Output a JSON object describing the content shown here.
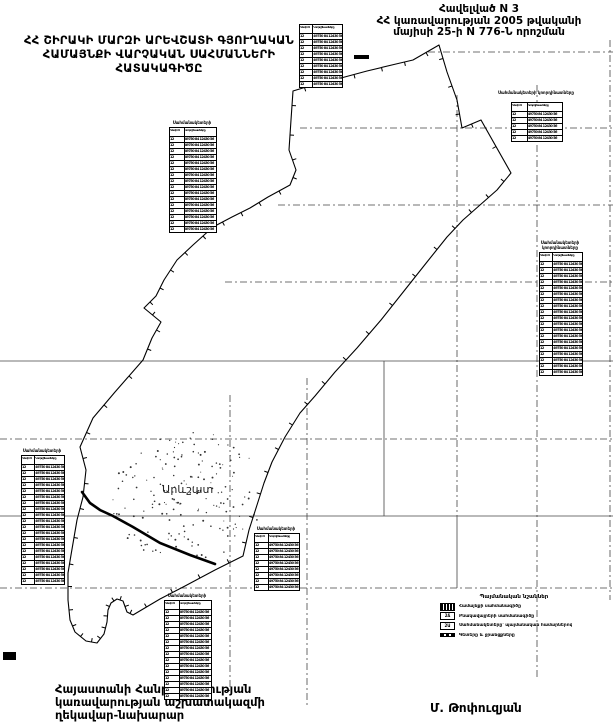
{
  "header_right": {
    "line1": "Հավելված N 3",
    "line2": "ՀՀ կառավարության 2005 թվականի",
    "line3": "մայիսի 25-ի N 776-Ն որոշման"
  },
  "map_title": {
    "line1": "ՀՀ ՇԻՐԱԿԻ ՄԱՐԶԻ ԱՐԵՎՇԱՏԻ ԳՅՈՒՂԱԿԱՆ",
    "line2": "ՀԱՄԱՅՆՔԻ  ՎԱՐՉԱԿԱՆ  ՍԱՀՄԱՆՆԵՐԻ",
    "line3": "ՀԱՏԱԿԱԳԻԾԸ"
  },
  "map": {
    "settlement_label": "Արևշատ"
  },
  "footer": {
    "left_line1": "Հայաստանի Հանրապետության",
    "left_line2": "կառավարության աշխատակազմի",
    "left_line3": "ղեկավար-նախարար",
    "signature": "Մ. Թոփուզյան"
  },
  "tables": {
    "header_col1": "Կետի N",
    "header_col2": "Կոորդինատները",
    "filler_cell1": "12",
    "filler_cell2": "49750 84 12430 56",
    "default_title": "Սահմանակետերի կոորդինատները",
    "items": [
      {
        "id": "coords-top",
        "x": 299,
        "y": 24,
        "w": 42,
        "rows": 9,
        "title_lines": 0
      },
      {
        "id": "coords-upper-left",
        "x": 169,
        "y": 127,
        "w": 46,
        "rows": 16,
        "title_lines": 1
      },
      {
        "id": "coords-right-small",
        "x": 511,
        "y": 102,
        "w": 50,
        "rows": 5,
        "title_lines": 2
      },
      {
        "id": "coords-right-long",
        "x": 539,
        "y": 252,
        "w": 42,
        "rows": 19,
        "title_lines": 2
      },
      {
        "id": "coords-left",
        "x": 21,
        "y": 455,
        "w": 42,
        "rows": 20,
        "title_lines": 1
      },
      {
        "id": "coords-center",
        "x": 254,
        "y": 533,
        "w": 44,
        "rows": 8,
        "title_lines": 1
      },
      {
        "id": "coords-bottom",
        "x": 164,
        "y": 600,
        "w": 46,
        "rows": 15,
        "title_lines": 1
      }
    ]
  },
  "legend": {
    "title": "Պայմանական նշաններ",
    "items": [
      {
        "symbol": "boundary-line-symbol",
        "style": "filled",
        "glyph": "",
        "label": "Համայնքի սահմանագիծը"
      },
      {
        "symbol": "parcel-code-symbol",
        "style": "code",
        "glyph": "2Ճ",
        "label": "Բնակավայրերի սահմանագիծը"
      },
      {
        "symbol": "point-number-symbol",
        "style": "code",
        "glyph": "2Ա",
        "label": "Սահմանակետերը՝ պայմանական համարներով"
      },
      {
        "symbol": "water-line-symbol",
        "style": "dashes",
        "glyph": "",
        "label": "Գետերը և ջրանցքները"
      }
    ]
  },
  "colors": {
    "line": "#000000",
    "grid": "#444444",
    "paper": "#ffffff"
  }
}
